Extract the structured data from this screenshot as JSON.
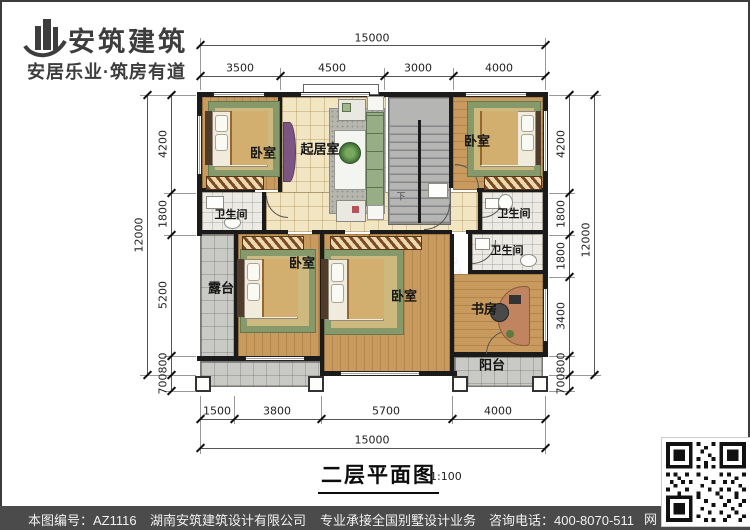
{
  "logo": {
    "name": "安筑建筑",
    "tagline": "安居乐业·筑房有道"
  },
  "plan": {
    "rooms": {
      "bedroom_tl": "卧室",
      "living": "起居室",
      "bedroom_tr": "卧室",
      "bath_l": "卫生间",
      "bath_r1": "卫生间",
      "bath_r2": "卫生间",
      "terrace": "露台",
      "bedroom_bl": "卧室",
      "bedroom_bc": "卧室",
      "study": "书房",
      "balcony": "阳台",
      "stairs_down": "下"
    },
    "dims": {
      "top_total": "15000",
      "top_segments": [
        "3500",
        "4500",
        "3000",
        "4000"
      ],
      "left_total": "12000",
      "left_segments": [
        "4200",
        "1800",
        "5200",
        "800",
        "700"
      ],
      "right_total": "12000",
      "right_segments": [
        "4200",
        "1800",
        "1800",
        "3400",
        "800",
        "700"
      ],
      "bottom_segments": [
        "1500",
        "3800",
        "5700",
        "4000"
      ],
      "bottom_total": "15000"
    }
  },
  "title": {
    "text": "二层平面图",
    "scale": "1:100"
  },
  "watermark": "hnazjz.com",
  "footer": {
    "drawing_no": "本图编号：AZ1116",
    "company": "湖南安筑建筑设计有限公司",
    "service": "专业承接全国别墅设计业务",
    "phone": "咨询电话：400-8070-511",
    "web_char": "网"
  },
  "colors": {
    "wall": "#1b1b1b",
    "wood": "#c89a5e",
    "tile_cream": "#f2e5c2",
    "tile_bath": "#eceae4",
    "tile_gray": "#c9c9c5",
    "footer_bar": "#4b4b4b"
  }
}
